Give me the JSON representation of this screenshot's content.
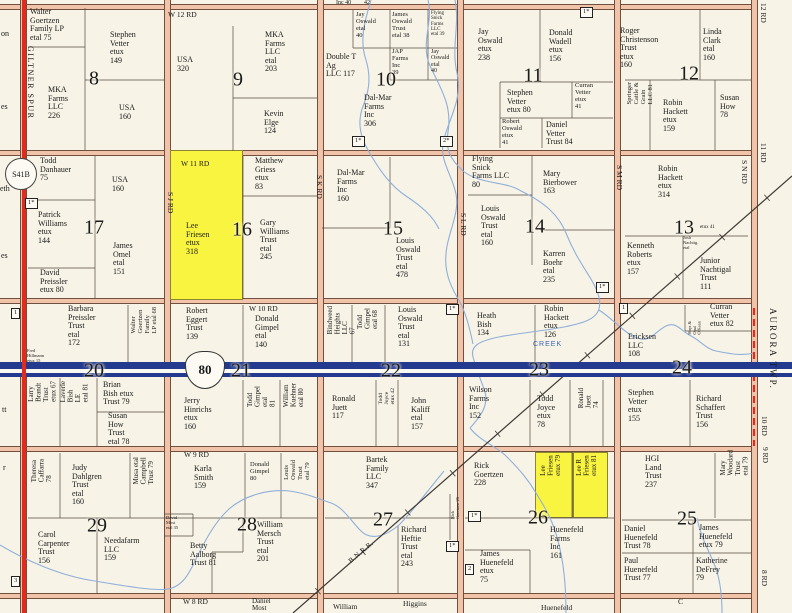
{
  "map": {
    "landmarks": {
      "aurora": "AURORA TWP.",
      "giltner": "GILTNER SPUR",
      "s41b": "S41B",
      "i80": "80",
      "bnrr": "B.N.R.R.",
      "creek": "CREEK"
    },
    "colors": {
      "highlight": "#f9f440",
      "road_fill": "#f1c3a9",
      "red_line": "#e02b1e",
      "interstate_blue": "#243a8e",
      "creek_blue": "#8fafdb"
    },
    "sections": [
      {
        "n": "8",
        "x": 94,
        "y": 79
      },
      {
        "n": "9",
        "x": 238,
        "y": 80
      },
      {
        "n": "10",
        "x": 386,
        "y": 80
      },
      {
        "n": "11",
        "x": 533,
        "y": 76
      },
      {
        "n": "12",
        "x": 689,
        "y": 74
      },
      {
        "n": "17",
        "x": 94,
        "y": 228
      },
      {
        "n": "16",
        "x": 242,
        "y": 230
      },
      {
        "n": "15",
        "x": 393,
        "y": 229
      },
      {
        "n": "14",
        "x": 535,
        "y": 227
      },
      {
        "n": "13",
        "x": 684,
        "y": 228
      },
      {
        "n": "20",
        "x": 94,
        "y": 371
      },
      {
        "n": "21",
        "x": 241,
        "y": 371
      },
      {
        "n": "22",
        "x": 391,
        "y": 371
      },
      {
        "n": "23",
        "x": 539,
        "y": 370
      },
      {
        "n": "24",
        "x": 682,
        "y": 368
      },
      {
        "n": "29",
        "x": 97,
        "y": 526
      },
      {
        "n": "28",
        "x": 247,
        "y": 525
      },
      {
        "n": "27",
        "x": 383,
        "y": 520
      },
      {
        "n": "26",
        "x": 538,
        "y": 518
      },
      {
        "n": "25",
        "x": 687,
        "y": 519
      }
    ],
    "road_labels_h": [
      {
        "t": "W 12 RD",
        "x": 168,
        "y": 10
      },
      {
        "t": "W 11 RD",
        "x": 181,
        "y": 159
      },
      {
        "t": "W 10 RD",
        "x": 249,
        "y": 304
      },
      {
        "t": "W 9 RD",
        "x": 184,
        "y": 450
      },
      {
        "t": "W 8 RD",
        "x": 183,
        "y": 597
      }
    ],
    "road_labels_v": [
      {
        "t": "S J RD",
        "x": 166,
        "y": 192
      },
      {
        "t": "S K RD",
        "x": 315,
        "y": 175
      },
      {
        "t": "S L RD",
        "x": 459,
        "y": 213
      },
      {
        "t": "S M RD",
        "x": 615,
        "y": 165
      },
      {
        "t": "S N RD",
        "x": 740,
        "y": 160
      }
    ],
    "edge_labels": [
      {
        "t": "12 RD",
        "x": 759,
        "y": 3
      },
      {
        "t": "11 RD",
        "x": 759,
        "y": 143
      },
      {
        "t": "10 RD",
        "x": 760,
        "y": 416
      },
      {
        "t": "9 RD",
        "x": 761,
        "y": 447
      },
      {
        "t": "8 RD",
        "x": 760,
        "y": 570
      }
    ],
    "parcels": [
      {
        "t": "Walter\nGoertzen\nFamily LP\netal      75",
        "x": 30,
        "y": 8
      },
      {
        "t": "Stephen\nVetter\netux\n149",
        "x": 110,
        "y": 31
      },
      {
        "t": "MKA\nFarms\nLLC\n226",
        "x": 48,
        "y": 86
      },
      {
        "t": "USA\n160",
        "x": 119,
        "y": 104
      },
      {
        "t": "USA\n320",
        "x": 177,
        "y": 56
      },
      {
        "t": "MKA\nFarms\nLLC\netal\n203",
        "x": 265,
        "y": 31
      },
      {
        "t": "Kevin\nElge\n124",
        "x": 264,
        "y": 110
      },
      {
        "t": "Jay\nOswald\netal\n40",
        "x": 356,
        "y": 12,
        "fs": 6.5
      },
      {
        "t": "James\nOswald\nTrust\netal   38",
        "x": 392,
        "y": 12,
        "fs": 6.5
      },
      {
        "t": "Flying\nSnick\nFarms\nLLC\netal 39",
        "x": 431,
        "y": 11,
        "fs": 5
      },
      {
        "t": "Double T\nAg\nLLC    117",
        "x": 326,
        "y": 53
      },
      {
        "t": "JAP\nFarms\nInc\n        39",
        "x": 392,
        "y": 49,
        "fs": 6.5
      },
      {
        "t": "Jay\nOswald\netal\n40",
        "x": 431,
        "y": 49,
        "fs": 6
      },
      {
        "t": "Dal-Mar\nFarms\nInc\n306",
        "x": 364,
        "y": 94
      },
      {
        "t": "Jay\nOswald\netux\n238",
        "x": 478,
        "y": 28
      },
      {
        "t": "Donald\nWadell\netux\n156",
        "x": 549,
        "y": 29
      },
      {
        "t": "Stephen\nVetter\netux         80",
        "x": 507,
        "y": 89
      },
      {
        "t": "Curran\nVetter\netux\n41",
        "x": 575,
        "y": 83,
        "fs": 6.5
      },
      {
        "t": "Robert\nOswald\netux\n41",
        "x": 502,
        "y": 119,
        "fs": 6.5
      },
      {
        "t": "Daniel\nVetter\nTrust    84",
        "x": 546,
        "y": 121
      },
      {
        "t": "Roger\nChristenson\nTrust\netux\n160",
        "x": 620,
        "y": 27
      },
      {
        "t": "Linda\nClark\netal\n160",
        "x": 703,
        "y": 28
      },
      {
        "t": "Springer\nCattle &\nGrain\nLLC       81",
        "x": 627,
        "y": 82,
        "v": 1,
        "fs": 6.5
      },
      {
        "t": "Robin\nHackett\netux\n159",
        "x": 663,
        "y": 99
      },
      {
        "t": "Susan\nHow\n78",
        "x": 720,
        "y": 94
      },
      {
        "t": "Todd\nDanhauer\n75",
        "x": 40,
        "y": 157
      },
      {
        "t": "USA\n160",
        "x": 112,
        "y": 176
      },
      {
        "t": "Patrick\nWilliams\netux\n144",
        "x": 38,
        "y": 211
      },
      {
        "t": "James\nOmel\netal\n151",
        "x": 113,
        "y": 242
      },
      {
        "t": "David\nPreissler\netux   80",
        "x": 40,
        "y": 269
      },
      {
        "t": "Lee\nFriesen\netux\n318",
        "x": 186,
        "y": 222,
        "hl": 1
      },
      {
        "t": "Matthew\nGriess\netux\n83",
        "x": 255,
        "y": 157
      },
      {
        "t": "Gary\nWilliams\nTrust\netal\n245",
        "x": 260,
        "y": 219
      },
      {
        "t": "Dal-Mar\nFarms\nInc\n160",
        "x": 337,
        "y": 169
      },
      {
        "t": "Louis\nOswald\nTrust\netal\n478",
        "x": 396,
        "y": 237
      },
      {
        "t": "Flying\nSnick\nFarms LLC\n80",
        "x": 472,
        "y": 155
      },
      {
        "t": "Mary\nBierbower\n163",
        "x": 543,
        "y": 170
      },
      {
        "t": "Louis\nOswald\nTrust\netal\n160",
        "x": 481,
        "y": 205
      },
      {
        "t": "Karren\nBoehr\netal\n235",
        "x": 543,
        "y": 250
      },
      {
        "t": "Robin\nHackett\netux\n314",
        "x": 658,
        "y": 165
      },
      {
        "t": "Kenneth\nRoberts\netux\n157",
        "x": 627,
        "y": 242
      },
      {
        "t": "Junior\nNachtigal\nTrust\n111",
        "x": 700,
        "y": 257
      },
      {
        "t": "Josh\nNachtig.\netal",
        "x": 683,
        "y": 236,
        "fs": 4.5
      },
      {
        "t": "etux   41",
        "x": 700,
        "y": 225,
        "fs": 5
      },
      {
        "t": "Barbara\nPreissler\nTrust\netal\n172",
        "x": 68,
        "y": 305
      },
      {
        "t": "Walter\nGoertzen\nFamily\nLP etal   68",
        "x": 131,
        "y": 307,
        "v": 1,
        "fs": 6.5
      },
      {
        "t": "Fred\nHillmann\netux 15",
        "x": 27,
        "y": 349,
        "fs": 4.5
      },
      {
        "t": "Larry\nBrandt\nTrust\netux    67",
        "x": 28,
        "y": 381,
        "v": 1,
        "fs": 7
      },
      {
        "t": "Laverle\nBish\nLE\netal    81",
        "x": 60,
        "y": 381,
        "v": 1,
        "fs": 7
      },
      {
        "t": "Brian\nBish    etux\nTrust   79",
        "x": 103,
        "y": 381
      },
      {
        "t": "Susan\nHow\nTrust\netal      78",
        "x": 108,
        "y": 412
      },
      {
        "t": "Robert\nEggert\nTrust\n139",
        "x": 186,
        "y": 307
      },
      {
        "t": "Donald\nGimpel\netal\n140",
        "x": 255,
        "y": 315
      },
      {
        "t": "Jerry\nHinrichs\netux\n160",
        "x": 184,
        "y": 397
      },
      {
        "t": "Todd\nGimpel\netal\n81",
        "x": 247,
        "y": 386,
        "v": 1,
        "fs": 7
      },
      {
        "t": "William\nKuehner\netal   80",
        "x": 283,
        "y": 383,
        "v": 1,
        "fs": 7
      },
      {
        "t": "Bindweed\nHeights\nLLC\n67",
        "x": 327,
        "y": 306,
        "v": 1,
        "fs": 7
      },
      {
        "t": "Todd\nGimpel\netal    68",
        "x": 357,
        "y": 308,
        "v": 1,
        "fs": 7
      },
      {
        "t": "Louis\nOswald\nTrust\netal\n131",
        "x": 398,
        "y": 306
      },
      {
        "t": "Ronald\nJuett\n117",
        "x": 332,
        "y": 395
      },
      {
        "t": "Todd\nJoyce\netux  42",
        "x": 379,
        "y": 388,
        "v": 1,
        "fs": 5.5
      },
      {
        "t": "John\nKaliff\netal\n157",
        "x": 411,
        "y": 397
      },
      {
        "t": "Heath\nBish\n134",
        "x": 477,
        "y": 312
      },
      {
        "t": "Robin\nHackett\netux\n126",
        "x": 544,
        "y": 305
      },
      {
        "t": "Wilson\nFarms\nInc\n152",
        "x": 469,
        "y": 386
      },
      {
        "t": "Todd\nJoyce\netux\n78",
        "x": 537,
        "y": 395
      },
      {
        "t": "Ronald\nJuett\n74",
        "x": 578,
        "y": 388,
        "v": 1,
        "fs": 7
      },
      {
        "t": "Ericksen\nLLC\n108",
        "x": 628,
        "y": 333
      },
      {
        "t": "Curran\nVetter\netux     82",
        "x": 710,
        "y": 303
      },
      {
        "t": "Hoyt &\nOpal\nO'Kean",
        "x": 688,
        "y": 321,
        "v": 1,
        "fs": 4.5
      },
      {
        "t": "Stephen\nVetter\netux\n155",
        "x": 628,
        "y": 389
      },
      {
        "t": "Richard\nSchaffert\nTrust\n156",
        "x": 696,
        "y": 395
      },
      {
        "t": "Theresa\nCaffarra\n78",
        "x": 31,
        "y": 459,
        "v": 1,
        "fs": 7
      },
      {
        "t": "Judy\nDahlgren\nTrust\netal\n160",
        "x": 72,
        "y": 464
      },
      {
        "t": "Musa   etal\nCampbell\nTrust      79",
        "x": 133,
        "y": 457,
        "v": 1,
        "fs": 7
      },
      {
        "t": "Carol\nCarpenter\nTrust\n156",
        "x": 38,
        "y": 531
      },
      {
        "t": "Needafarm\nLLC\n159",
        "x": 104,
        "y": 537
      },
      {
        "t": "Karla\nSmith\n159",
        "x": 194,
        "y": 465
      },
      {
        "t": "Donald\nGimpel\n80",
        "x": 250,
        "y": 462,
        "fs": 6.5
      },
      {
        "t": "Louis\nOswald\nTrust\netal    79",
        "x": 284,
        "y": 460,
        "v": 1,
        "fs": 6.5
      },
      {
        "t": "David\nMost\netal 35",
        "x": 166,
        "y": 516,
        "fs": 4.5
      },
      {
        "t": "Betty\nAalborg\nTrust    81",
        "x": 190,
        "y": 542
      },
      {
        "t": "William\nMersch\nTrust\netal\n201",
        "x": 257,
        "y": 521
      },
      {
        "t": "Bartek\nFamily\nLLC\n347",
        "x": 366,
        "y": 456
      },
      {
        "t": "Richard\nHeftie\nTrust\netal\n243",
        "x": 401,
        "y": 526
      },
      {
        "t": "Rick\nGoertzen  25",
        "x": 451,
        "y": 497,
        "v": 1,
        "fs": 4.5
      },
      {
        "t": "Rick\nGoertzen\n228",
        "x": 474,
        "y": 462
      },
      {
        "t": "Lee\nFriesen\netux    79",
        "x": 540,
        "y": 455,
        "v": 1,
        "fs": 7,
        "hl": 1
      },
      {
        "t": "Lee R\nFriesen\netux    81",
        "x": 576,
        "y": 455,
        "v": 1,
        "fs": 7,
        "hl": 1
      },
      {
        "t": "Huenefeld\nFarms\nInc\n161",
        "x": 550,
        "y": 526
      },
      {
        "t": "James\nHuenefeld\netux\n75",
        "x": 480,
        "y": 550
      },
      {
        "t": "HGI\nLand\nTrust\n237",
        "x": 645,
        "y": 455
      },
      {
        "t": "Mary\nWoodard\nTrust\netal    79",
        "x": 720,
        "y": 450,
        "v": 1,
        "fs": 7
      },
      {
        "t": "Daniel\nHuenefeld\nTrust      78",
        "x": 624,
        "y": 525
      },
      {
        "t": "James\nHuenefeld\netux     79",
        "x": 699,
        "y": 524
      },
      {
        "t": "Paul\nHuenefeld\nTrust     77",
        "x": 624,
        "y": 557
      },
      {
        "t": "Katherine\nDeFrey\n79",
        "x": 696,
        "y": 557
      }
    ],
    "markers": [
      {
        "t": "1*",
        "x": 352,
        "y": 136
      },
      {
        "t": "2*",
        "x": 440,
        "y": 136
      },
      {
        "t": "1*",
        "x": 580,
        "y": 7
      },
      {
        "t": "1*",
        "x": 25,
        "y": 198
      },
      {
        "t": "1*",
        "x": 596,
        "y": 282
      },
      {
        "t": "1*",
        "x": 446,
        "y": 304
      },
      {
        "t": "1",
        "x": 11,
        "y": 308
      },
      {
        "t": "1",
        "x": 619,
        "y": 303
      },
      {
        "t": "3",
        "x": 11,
        "y": 576
      },
      {
        "t": "1*",
        "x": 468,
        "y": 511
      },
      {
        "t": "1*",
        "x": 446,
        "y": 541
      },
      {
        "t": "2",
        "x": 465,
        "y": 564
      }
    ],
    "fragments": [
      {
        "t": "Inc 40",
        "x": 336,
        "y": 0,
        "fs": 6
      },
      {
        "t": "42",
        "x": 364,
        "y": 0,
        "fs": 6
      },
      {
        "t": "on",
        "x": 1,
        "y": 30
      },
      {
        "t": "es",
        "x": 1,
        "y": 103
      },
      {
        "t": "eth",
        "x": 0,
        "y": 185
      },
      {
        "t": "es",
        "x": 1,
        "y": 252
      },
      {
        "t": "tt",
        "x": 2,
        "y": 406
      },
      {
        "t": "r",
        "x": 3,
        "y": 464
      },
      {
        "t": "Daniel\nMost",
        "x": 252,
        "y": 598,
        "fs": 7
      },
      {
        "t": "William",
        "x": 333,
        "y": 603,
        "fs": 7.5
      },
      {
        "t": "Higgins",
        "x": 403,
        "y": 600,
        "fs": 7.5
      },
      {
        "t": "Huenefeld",
        "x": 541,
        "y": 604,
        "fs": 7.5
      },
      {
        "t": "C",
        "x": 678,
        "y": 598,
        "fs": 7.5
      }
    ]
  }
}
